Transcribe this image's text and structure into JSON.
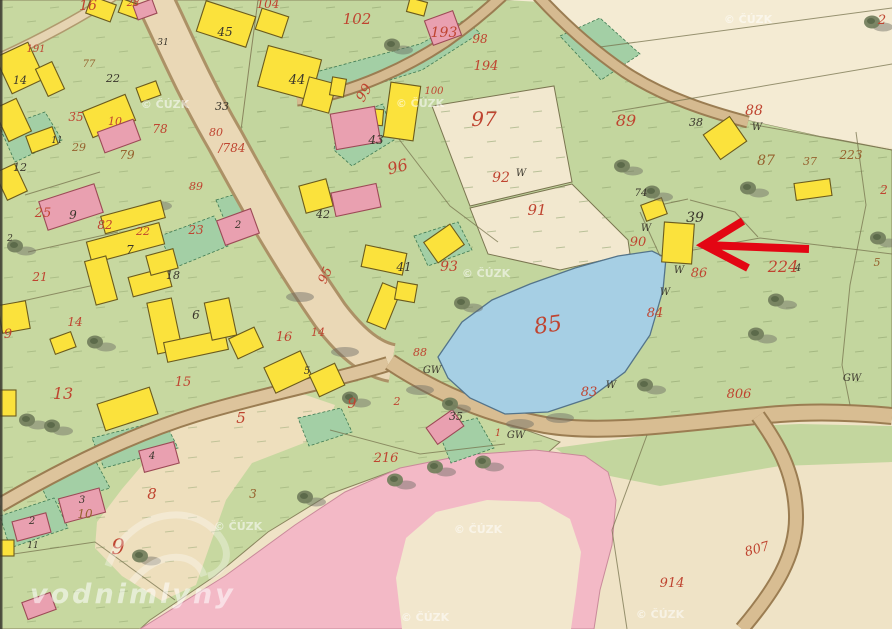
{
  "map": {
    "type": "historical-cadastral-map",
    "colors": {
      "parcel_red": "#bf4430",
      "house_black": "#3a362c",
      "ink_brown": "#96622e",
      "water_blue": "#a6cfe4",
      "building_wood_yellow": "#fbe23c",
      "building_masonry_pink": "#e9a0b0",
      "meadow_green": "#c7d8a0",
      "garden_green": "#a3cfa5",
      "field_cream": "#efe3c6",
      "road_tan": "#d8bd92",
      "pasture_pink": "#f3b9c6",
      "arrow_red": "#e30613",
      "watermark_white": "#ffffff"
    },
    "labels": {
      "parcel_numbers_red": [
        [
          "16",
          88,
          10,
          14,
          0
        ],
        [
          "104",
          268,
          8,
          12,
          0
        ],
        [
          "102",
          357,
          24,
          15,
          0
        ],
        [
          "193",
          444,
          37,
          14,
          0
        ],
        [
          "98",
          480,
          43,
          12,
          0
        ],
        [
          "194",
          486,
          70,
          13,
          0
        ],
        [
          "99",
          368,
          95,
          14,
          -60
        ],
        [
          "100",
          434,
          94,
          10,
          0
        ],
        [
          "97",
          484,
          126,
          20,
          0
        ],
        [
          "92",
          501,
          182,
          14,
          0
        ],
        [
          "91",
          537,
          215,
          15,
          0
        ],
        [
          "96",
          399,
          172,
          16,
          -15
        ],
        [
          "89",
          626,
          126,
          16,
          0
        ],
        [
          "88",
          754,
          115,
          14,
          0
        ],
        [
          "2",
          882,
          24,
          13,
          0
        ],
        [
          "2",
          884,
          194,
          12,
          0
        ],
        [
          "90",
          638,
          246,
          13,
          0
        ],
        [
          "86",
          699,
          277,
          13,
          0
        ],
        [
          "84",
          655,
          317,
          13,
          0
        ],
        [
          "224",
          783,
          272,
          16,
          0
        ],
        [
          "85",
          549,
          332,
          22,
          -8
        ],
        [
          "83",
          589,
          396,
          13,
          0
        ],
        [
          "806",
          739,
          398,
          13,
          0
        ],
        [
          "88",
          420,
          356,
          11,
          0
        ],
        [
          "95",
          329,
          277,
          13,
          -65
        ],
        [
          "93",
          449,
          271,
          14,
          0
        ],
        [
          "9",
          352,
          408,
          14,
          0
        ],
        [
          "2",
          397,
          405,
          11,
          0
        ],
        [
          "216",
          386,
          462,
          13,
          0
        ],
        [
          "1",
          498,
          436,
          10,
          0
        ],
        [
          "914",
          672,
          587,
          13,
          0
        ],
        [
          "807",
          758,
          553,
          13,
          -15
        ],
        [
          "16",
          284,
          341,
          13,
          0
        ],
        [
          "14",
          318,
          336,
          11,
          0
        ],
        [
          "5",
          241,
          423,
          15,
          0
        ],
        [
          "13",
          63,
          399,
          16,
          0
        ],
        [
          "15",
          183,
          386,
          13,
          0
        ],
        [
          "9",
          8,
          338,
          13,
          0
        ],
        [
          "14",
          75,
          326,
          12,
          0
        ],
        [
          "21",
          40,
          281,
          12,
          0
        ],
        [
          "25",
          43,
          217,
          13,
          0
        ],
        [
          "82",
          105,
          229,
          12,
          0
        ],
        [
          "22",
          143,
          235,
          11,
          0
        ],
        [
          "23",
          196,
          234,
          12,
          0
        ],
        [
          "35",
          76,
          121,
          12,
          0
        ],
        [
          "10",
          115,
          125,
          11,
          0
        ],
        [
          "78",
          160,
          133,
          12,
          0
        ],
        [
          "80",
          216,
          136,
          11,
          0
        ],
        [
          "/784",
          232,
          152,
          12,
          0
        ],
        [
          "191",
          36,
          52,
          10,
          0
        ],
        [
          "28",
          133,
          6,
          10,
          0
        ],
        [
          "8",
          152,
          499,
          15,
          0
        ],
        [
          "9",
          118,
          554,
          21,
          0
        ],
        [
          "89",
          196,
          190,
          11,
          0
        ]
      ],
      "parcel_numbers_brown": [
        [
          "87",
          766,
          165,
          14,
          0
        ],
        [
          "37",
          810,
          165,
          11,
          0
        ],
        [
          "223",
          851,
          159,
          12,
          0
        ],
        [
          "77",
          89,
          67,
          10,
          0
        ],
        [
          "29",
          79,
          151,
          11,
          0
        ],
        [
          "79",
          127,
          159,
          12,
          0
        ],
        [
          "10",
          85,
          518,
          12,
          0
        ],
        [
          "3",
          253,
          498,
          12,
          0
        ],
        [
          "5",
          877,
          266,
          11,
          0
        ]
      ],
      "house_numbers_black": [
        [
          "45",
          225,
          36,
          12,
          0
        ],
        [
          "44",
          297,
          84,
          13,
          0
        ],
        [
          "31",
          163,
          45,
          9,
          0
        ],
        [
          "33",
          222,
          110,
          11,
          0
        ],
        [
          "14",
          20,
          84,
          11,
          0
        ],
        [
          "22",
          113,
          82,
          11,
          0
        ],
        [
          "12",
          20,
          171,
          11,
          0
        ],
        [
          "11",
          57,
          143,
          9,
          0
        ],
        [
          "43",
          376,
          144,
          12,
          0
        ],
        [
          "42",
          323,
          218,
          11,
          0
        ],
        [
          "41",
          404,
          271,
          12,
          0
        ],
        [
          "39",
          695,
          222,
          14,
          0
        ],
        [
          "38",
          696,
          126,
          11,
          0
        ],
        [
          "74",
          641,
          196,
          10,
          0
        ],
        [
          "7",
          130,
          254,
          12,
          0
        ],
        [
          "18",
          173,
          279,
          11,
          0
        ],
        [
          "6",
          196,
          319,
          12,
          0
        ],
        [
          "9",
          73,
          219,
          12,
          0
        ],
        [
          "2",
          238,
          228,
          10,
          0
        ],
        [
          "5",
          307,
          374,
          10,
          0
        ],
        [
          "35",
          456,
          420,
          11,
          0
        ],
        [
          "4",
          152,
          459,
          10,
          0
        ],
        [
          "3",
          82,
          503,
          10,
          0
        ],
        [
          "2",
          32,
          524,
          10,
          0
        ],
        [
          "11",
          33,
          548,
          9,
          0
        ],
        [
          "2",
          10,
          241,
          9,
          0
        ],
        [
          "4",
          798,
          271,
          10,
          0
        ]
      ],
      "wetland_quality_marks": [
        [
          "W",
          521,
          176
        ],
        [
          "W",
          646,
          231
        ],
        [
          "W",
          679,
          273
        ],
        [
          "W",
          665,
          295
        ],
        [
          "W",
          611,
          388
        ],
        [
          "GW",
          852,
          381
        ],
        [
          "GW",
          432,
          373
        ],
        [
          "GW",
          516,
          438
        ],
        [
          "W",
          757,
          130
        ]
      ]
    },
    "watermarks": {
      "site_text": "vodnimlyny",
      "site_pos": [
        30,
        603
      ],
      "site_size": 27,
      "copyright_text": "© ČÚZK",
      "copyright_positions": [
        [
          165,
          108
        ],
        [
          420,
          107
        ],
        [
          748,
          23
        ],
        [
          486,
          277
        ],
        [
          238,
          530
        ],
        [
          478,
          533
        ],
        [
          425,
          621
        ],
        [
          660,
          618
        ]
      ]
    },
    "annotation_arrow": {
      "color": "#e30613",
      "width": 8,
      "tip": [
        704,
        245
      ],
      "shaft_end": [
        809,
        249
      ],
      "head_upper": [
        743,
        221
      ],
      "head_lower": [
        748,
        268
      ],
      "points_at_house_number": "39"
    },
    "buildings": {
      "wooden_yellow": [
        [
          2,
          48,
          36,
          40,
          -25
        ],
        [
          41,
          64,
          18,
          30,
          -25
        ],
        [
          0,
          102,
          25,
          36,
          -25
        ],
        [
          86,
          102,
          46,
          28,
          -22
        ],
        [
          138,
          84,
          21,
          15,
          -20
        ],
        [
          88,
          0,
          26,
          18,
          20
        ],
        [
          120,
          2,
          20,
          14,
          20
        ],
        [
          200,
          8,
          52,
          32,
          18
        ],
        [
          258,
          12,
          28,
          22,
          18
        ],
        [
          262,
          52,
          55,
          42,
          15
        ],
        [
          305,
          80,
          28,
          30,
          15
        ],
        [
          331,
          78,
          14,
          18,
          10
        ],
        [
          387,
          84,
          30,
          55,
          8
        ],
        [
          366,
          109,
          17,
          16,
          5
        ],
        [
          302,
          182,
          28,
          28,
          -15
        ],
        [
          28,
          131,
          28,
          18,
          -20
        ],
        [
          0,
          167,
          22,
          30,
          -25
        ],
        [
          102,
          208,
          62,
          18,
          -15
        ],
        [
          88,
          232,
          75,
          22,
          -15
        ],
        [
          90,
          258,
          22,
          45,
          -15
        ],
        [
          130,
          272,
          40,
          20,
          -15
        ],
        [
          148,
          252,
          28,
          20,
          -15
        ],
        [
          152,
          300,
          25,
          52,
          -12
        ],
        [
          165,
          336,
          62,
          20,
          -12
        ],
        [
          208,
          300,
          25,
          38,
          -12
        ],
        [
          0,
          303,
          28,
          28,
          -10
        ],
        [
          52,
          335,
          22,
          16,
          -20
        ],
        [
          100,
          395,
          55,
          28,
          -18
        ],
        [
          0,
          390,
          16,
          26,
          0
        ],
        [
          232,
          332,
          28,
          22,
          -25
        ],
        [
          268,
          358,
          40,
          28,
          -25
        ],
        [
          313,
          368,
          28,
          24,
          -25
        ],
        [
          363,
          249,
          42,
          22,
          12
        ],
        [
          374,
          285,
          20,
          42,
          22
        ],
        [
          396,
          283,
          20,
          18,
          10
        ],
        [
          428,
          231,
          32,
          25,
          -35
        ],
        [
          643,
          201,
          22,
          17,
          -20
        ],
        [
          709,
          123,
          32,
          30,
          -35
        ],
        [
          795,
          181,
          36,
          17,
          -8
        ],
        [
          408,
          0,
          18,
          14,
          15
        ],
        [
          0,
          540,
          14,
          16,
          0
        ]
      ],
      "arrow_target_building": [
        663,
        223,
        30,
        40,
        4
      ],
      "masonry_pink": [
        [
          428,
          15,
          30,
          26,
          -20
        ],
        [
          135,
          2,
          20,
          15,
          -20
        ],
        [
          333,
          110,
          45,
          36,
          -10
        ],
        [
          333,
          188,
          46,
          24,
          -12
        ],
        [
          100,
          125,
          38,
          22,
          -20
        ],
        [
          42,
          192,
          58,
          30,
          -18
        ],
        [
          220,
          214,
          36,
          26,
          -20
        ],
        [
          141,
          446,
          36,
          22,
          -15
        ],
        [
          61,
          493,
          42,
          25,
          -15
        ],
        [
          14,
          517,
          35,
          20,
          -15
        ],
        [
          24,
          597,
          30,
          18,
          -20
        ],
        [
          429,
          417,
          32,
          20,
          -35
        ]
      ]
    },
    "trees": [
      [
        392,
        45
      ],
      [
        622,
        166
      ],
      [
        652,
        192
      ],
      [
        748,
        188
      ],
      [
        462,
        303
      ],
      [
        776,
        300
      ],
      [
        756,
        334
      ],
      [
        395,
        480
      ],
      [
        435,
        467
      ],
      [
        483,
        462
      ],
      [
        27,
        420
      ],
      [
        52,
        426
      ],
      [
        305,
        497
      ],
      [
        878,
        238
      ],
      [
        140,
        556
      ],
      [
        95,
        342
      ],
      [
        15,
        246
      ],
      [
        645,
        385
      ],
      [
        872,
        22
      ],
      [
        350,
        398
      ],
      [
        450,
        404
      ]
    ],
    "shadow_smudges": [
      [
        158,
        206
      ],
      [
        300,
        297
      ],
      [
        345,
        352
      ],
      [
        420,
        390
      ],
      [
        520,
        424
      ],
      [
        560,
        418
      ]
    ]
  }
}
